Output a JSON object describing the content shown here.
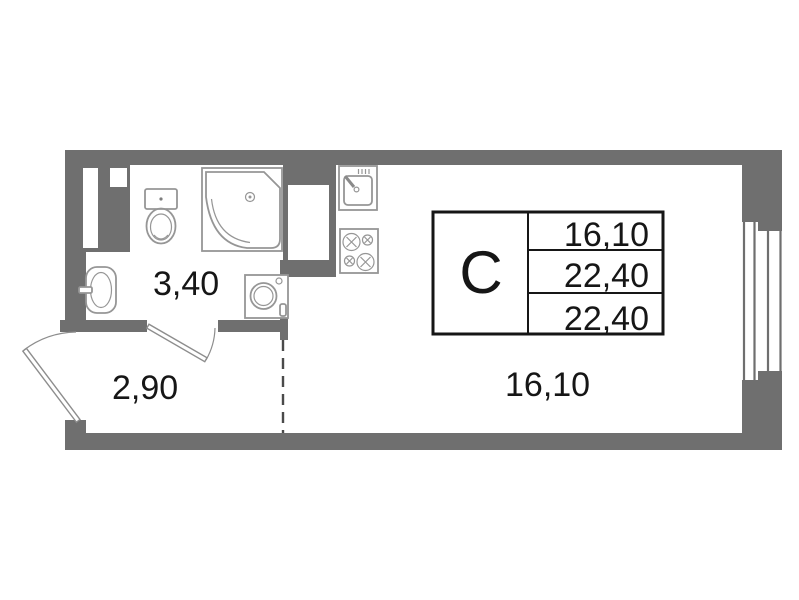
{
  "plan": {
    "stamp": {
      "type_label": "С",
      "row_values": [
        "16,10",
        "22,40",
        "22,40"
      ]
    },
    "room_labels": {
      "bathroom": "3,40",
      "hallway": "2,90",
      "main_room": "16,10"
    },
    "fixtures": [
      "corner-shower",
      "toilet",
      "washbasin",
      "washing-machine",
      "kitchen-sink",
      "stove-4-burner",
      "window",
      "entry-door",
      "bathroom-door",
      "zoning-dashed-line"
    ]
  },
  "colors": {
    "wall": "#6f6f6f",
    "fixture_stroke": "#969696",
    "door_stroke": "#8d8d8d",
    "dash": "#4a4a4a",
    "ink": "#161616",
    "background": "#ffffff"
  }
}
